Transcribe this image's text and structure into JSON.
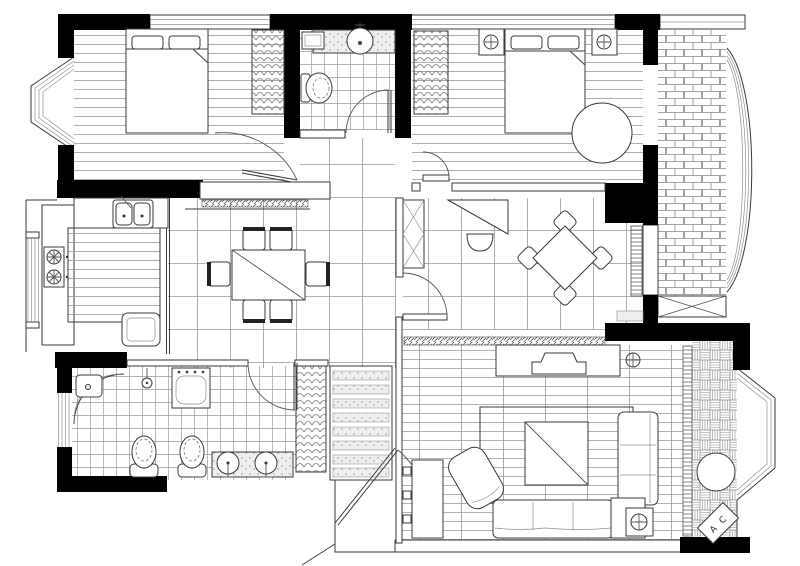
{
  "document": {
    "type": "architectural-floor-plan",
    "style": "black and white line drawing, no text labels except AC unit"
  },
  "colors": {
    "walls": "#000000",
    "lines": "#3a3a3a",
    "light_lines": "#8f8f8f",
    "background": "#ffffff",
    "stipple_fill": "#efefef"
  },
  "labels": {
    "ac_unit": "A C"
  },
  "rooms": [
    {
      "name": "bedroom-top-left",
      "floor": "wood-strips",
      "furniture": [
        "double-bed",
        "wardrobe",
        "bay-window"
      ]
    },
    {
      "name": "bathroom-top",
      "floor": "small-tile",
      "furniture": [
        "washbasin-counter",
        "toilet",
        "corner-shelf"
      ]
    },
    {
      "name": "bedroom-top-right",
      "floor": "wood-strips",
      "furniture": [
        "double-bed",
        "wardrobe",
        "nightstand-left",
        "nightstand-right",
        "round-chair"
      ]
    },
    {
      "name": "balcony-top-right",
      "floor": "brick",
      "features": [
        "curved-bay-window",
        "x-brace-window"
      ]
    },
    {
      "name": "kitchen",
      "floor": "plain",
      "furniture": [
        "double-sink",
        "two-burner-stove",
        "island-counter",
        "refrigerator"
      ]
    },
    {
      "name": "dining-room",
      "floor": "large-tile",
      "furniture": [
        "dining-table",
        "six-chairs",
        "sideboard"
      ]
    },
    {
      "name": "study",
      "floor": "large-tile",
      "furniture": [
        "drafting-desk",
        "chair",
        "diamond-game-table",
        "four-chairs",
        "bookshelf"
      ]
    },
    {
      "name": "bathroom-bottom-left",
      "floor": "small-tile",
      "furniture": [
        "corner-shower",
        "shower-head",
        "washing-machine",
        "toilet-1",
        "toilet-2",
        "double-washbasin-vanity"
      ]
    },
    {
      "name": "hall-closet",
      "floor": "large-tile",
      "furniture": [
        "wardrobe-strip",
        "shelf-bands"
      ]
    },
    {
      "name": "entry",
      "features": [
        "entry-door-arc",
        "vestibule"
      ]
    },
    {
      "name": "living-room",
      "floor": "wood-planks",
      "furniture": [
        "tv-cabinet",
        "television",
        "rug",
        "coffee-table",
        "sectional-sofa",
        "corner-side-table",
        "lounge-chair",
        "media-wall-console",
        "lamp-symbol"
      ]
    },
    {
      "name": "balcony-bottom-right",
      "floor": "basketweave",
      "furniture": [
        "round-table",
        "air-conditioner-unit"
      ],
      "features": [
        "angled-bay-window"
      ]
    }
  ]
}
